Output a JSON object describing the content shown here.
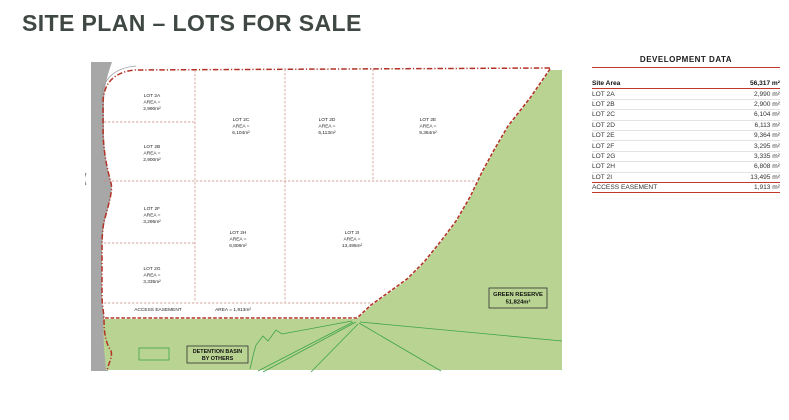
{
  "page": {
    "title": "SITE PLAN – LOTS FOR SALE"
  },
  "plan": {
    "area_eq": "AREA =",
    "lots": [
      {
        "id": "2A",
        "name": "LOT 2A",
        "area": "2,990m²"
      },
      {
        "id": "2B",
        "name": "LOT 2B",
        "area": "2,900m²"
      },
      {
        "id": "2C",
        "name": "LOT 2C",
        "area": "6,104m²"
      },
      {
        "id": "2D",
        "name": "LOT 2D",
        "area": "6,113m²"
      },
      {
        "id": "2E",
        "name": "LOT 2E",
        "area": "9,364m²"
      },
      {
        "id": "2F",
        "name": "LOT 2F",
        "area": "3,295m²"
      },
      {
        "id": "2G",
        "name": "LOT 2G",
        "area": "3,335m²"
      },
      {
        "id": "2H",
        "name": "LOT 2H",
        "area": "6,808m²"
      },
      {
        "id": "2I",
        "name": "LOT 2I",
        "area": "13,495m²"
      }
    ],
    "easement": {
      "label": "ACCESS EASEMENT",
      "area": "AREA = 1,913m²"
    },
    "green_reserve": {
      "label": "GREEN RESERVE",
      "area": "51,824m²"
    },
    "detention_basin": {
      "line1": "DETENTION BASIN",
      "line2": "BY OTHERS"
    },
    "colors": {
      "boundary_red": "#b23226",
      "lot_line_red": "#c6897d",
      "green_fill": "#b9d492",
      "green_line": "#3da34c",
      "road_gray": "#a7a7a7"
    }
  },
  "table": {
    "title": "DEVELOPMENT DATA",
    "accent": "#c0392b",
    "site_area": {
      "label": "Site Area",
      "value": "56,317 m²"
    },
    "rows": [
      {
        "label": "LOT 2A",
        "value": "2,990 m²"
      },
      {
        "label": "LOT 2B",
        "value": "2,900 m²"
      },
      {
        "label": "LOT 2C",
        "value": "6,104 m²"
      },
      {
        "label": "LOT 2D",
        "value": "6,113 m²"
      },
      {
        "label": "LOT 2E",
        "value": "9,364 m²"
      },
      {
        "label": "LOT 2F",
        "value": "3,295 m²"
      },
      {
        "label": "LOT 2G",
        "value": "3,335 m²"
      },
      {
        "label": "LOT 2H",
        "value": "6,808 m²"
      },
      {
        "label": "LOT 2I",
        "value": "13,495 m²"
      }
    ],
    "footer": {
      "label": "ACCESS EASEMENT",
      "value": "1,913 m²"
    }
  }
}
